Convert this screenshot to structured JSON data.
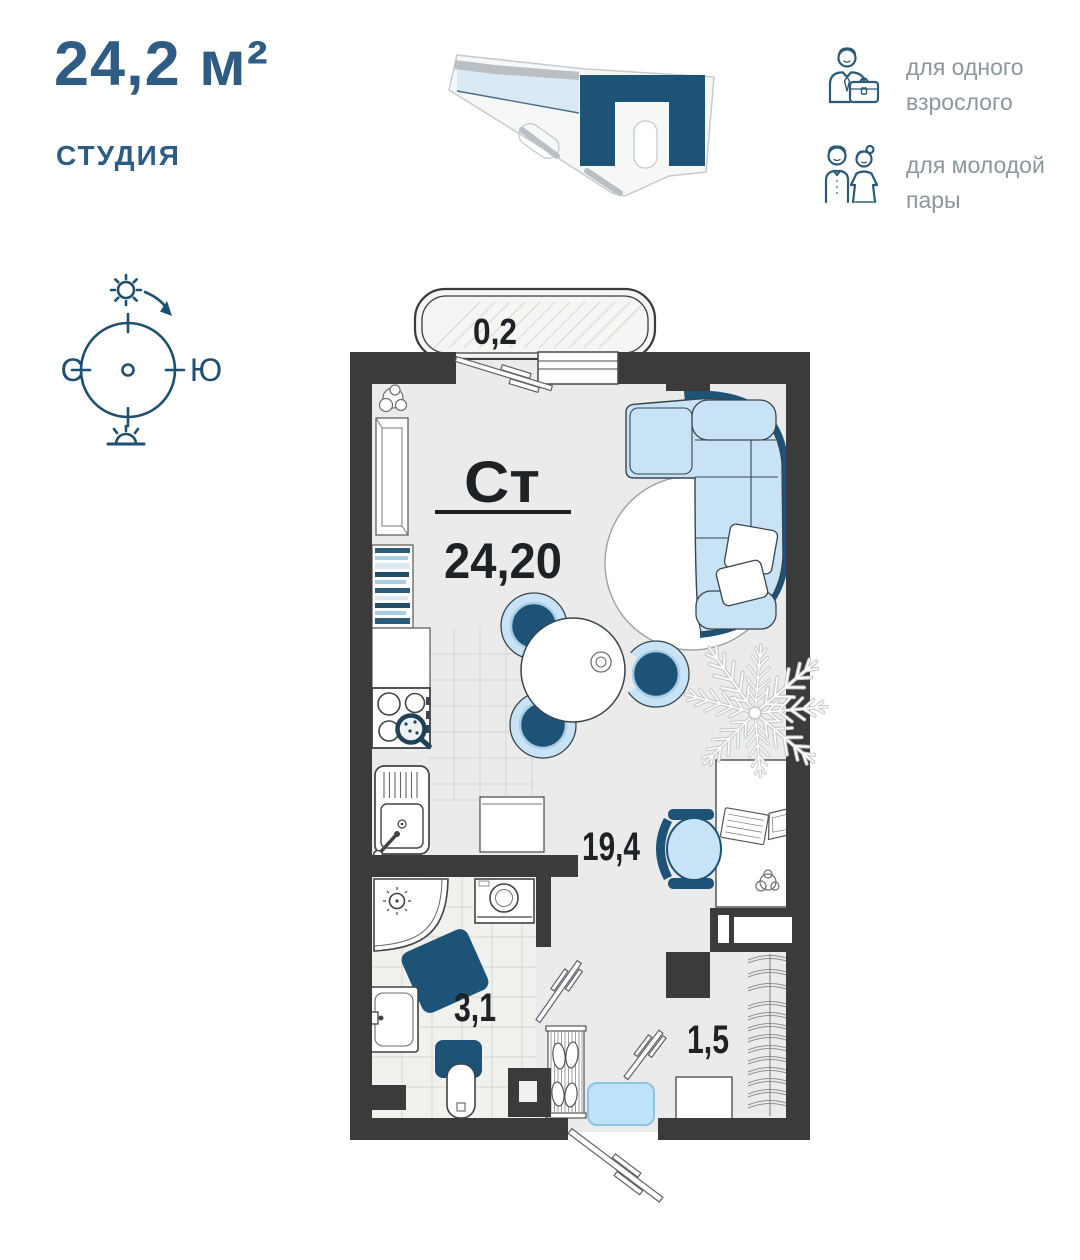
{
  "header": {
    "area_title": "24,2 м²",
    "type_label": "СТУДИЯ",
    "audience": [
      {
        "icon": "businessman-icon",
        "line1": "для одного",
        "line2": "взрослого"
      },
      {
        "icon": "couple-icon",
        "line1": "для молодой",
        "line2": "пары"
      }
    ]
  },
  "compass": {
    "north_label": "С",
    "south_label": "Ю"
  },
  "plan": {
    "unit_code": "Ст",
    "unit_area": "24,20",
    "rooms": [
      {
        "name": "balcony",
        "area": "0,2"
      },
      {
        "name": "living-room",
        "area": "19,4"
      },
      {
        "name": "bathroom",
        "area": "3,1"
      },
      {
        "name": "hallway",
        "area": "1,5"
      }
    ]
  },
  "colors": {
    "title_blue": "#2e5c85",
    "accent_dark_blue": "#1d5377",
    "accent_light_blue": "#c8e3f5",
    "wall_dark": "#3b3b3b",
    "label_gray": "#8b969d"
  }
}
